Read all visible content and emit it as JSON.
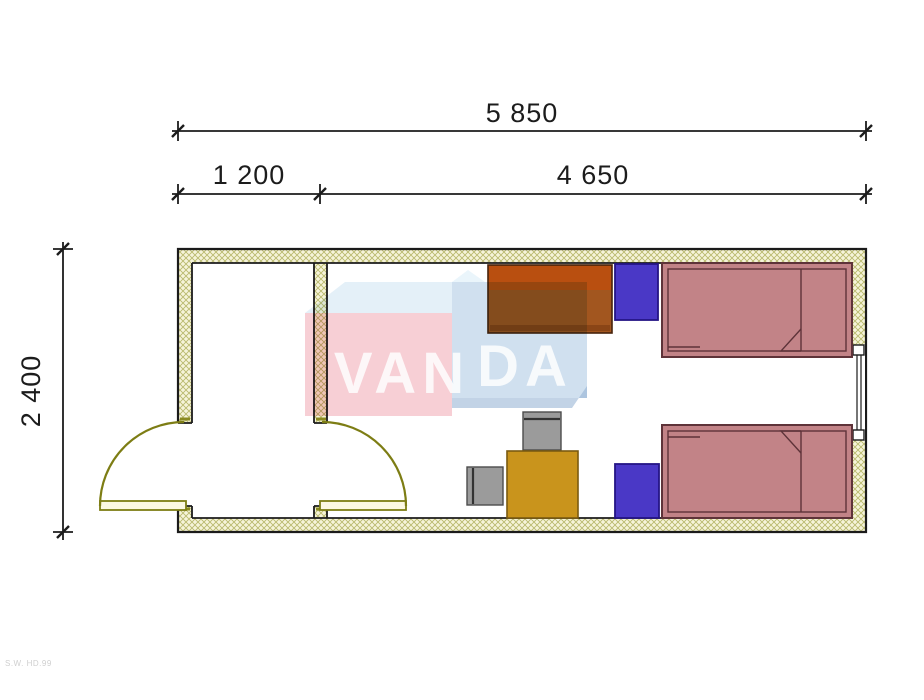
{
  "title": "Container floor plan 5850 x 2400 with two beds",
  "dimensions": {
    "total_width_label": "5 850",
    "entry_width_label": "1 200",
    "main_width_label": "4 650",
    "depth_label": "2 400"
  },
  "watermark": {
    "left_text": "VAN",
    "right_text": "DA",
    "pink": "#f0a8b2",
    "top_blue": "#cde3f2",
    "side_blue": "#a9c7e2",
    "shadow_blue": "#8fafd2",
    "peak_blue": "#d8ecf8",
    "letter_color": "#ffffff"
  },
  "plan": {
    "wall_hatch_bg": "#f6f4da",
    "wall_hatch_line": "#b9b96e",
    "wall_outline": "#1b1b1b",
    "door_color": "#7d7d14",
    "door_leaf_fill": "#fcf8e2",
    "rooms": [
      {
        "id": "entry",
        "width_mm": 1200
      },
      {
        "id": "bedroom",
        "width_mm": 4650
      }
    ],
    "furniture": [
      {
        "id": "desk",
        "label": "Desk",
        "color": "#a2561f",
        "accent": "#b94f10",
        "shadow": "#8a4516"
      },
      {
        "id": "wardrobe-top",
        "label": "Wardrobe",
        "color": "#4a38c6"
      },
      {
        "id": "wardrobe-bottom",
        "label": "Wardrobe",
        "color": "#4a38c6"
      },
      {
        "id": "bed-top",
        "label": "Single bed",
        "color": "#c28387",
        "outline": "#5e3339"
      },
      {
        "id": "bed-bottom",
        "label": "Single bed",
        "color": "#c28387",
        "outline": "#5e3339"
      },
      {
        "id": "table",
        "label": "Table",
        "color": "#c9941c"
      },
      {
        "id": "chair-top",
        "label": "Chair",
        "color": "#9b9b9b"
      },
      {
        "id": "chair-left",
        "label": "Chair",
        "color": "#9b9b9b"
      }
    ],
    "openings": [
      {
        "id": "entrance-door",
        "type": "door",
        "swing": "outward-left"
      },
      {
        "id": "interior-door",
        "type": "door",
        "swing": "into-bedroom"
      },
      {
        "id": "window-right",
        "type": "window"
      }
    ]
  },
  "footer_note": "S.W. HD.99"
}
